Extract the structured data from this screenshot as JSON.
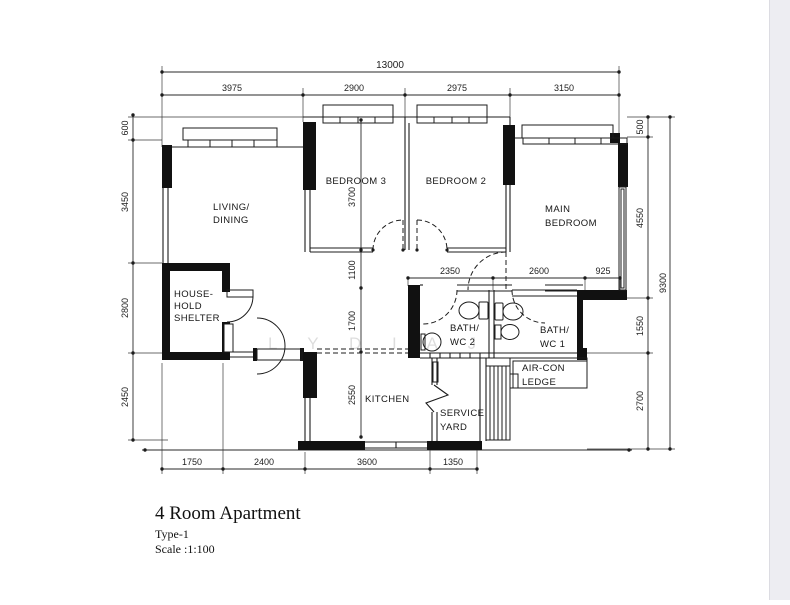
{
  "drawing": {
    "title": "4 Room Apartment",
    "type_label": "Type-1",
    "scale_label": "Scale :1:100",
    "watermark": "L Y D I A J"
  },
  "rooms": {
    "living_line1": "LIVING/",
    "living_line2": "DINING",
    "bedroom3": "BEDROOM 3",
    "bedroom2": "BEDROOM 2",
    "main_line1": "MAIN",
    "main_line2": "BEDROOM",
    "shelter_line1": "HOUSE-",
    "shelter_line2": "HOLD",
    "shelter_line3": "SHELTER",
    "bath2_line1": "BATH/",
    "bath2_line2": "WC 2",
    "bath1_line1": "BATH/",
    "bath1_line2": "WC 1",
    "kitchen": "KITCHEN",
    "service_line1": "SERVICE",
    "service_line2": "YARD",
    "aircon_line1": "AIR-CON",
    "aircon_line2": "LEDGE"
  },
  "dims": {
    "overall_width": "13000",
    "top": [
      "3975",
      "2900",
      "2975",
      "3150"
    ],
    "left": [
      "600",
      "3450",
      "2800",
      "2450"
    ],
    "right": [
      "500",
      "4550",
      "1550",
      "2700"
    ],
    "right_total": "9300",
    "bottom": [
      "1750",
      "2400",
      "3600",
      "1350"
    ],
    "inner_vertical": [
      "3700",
      "1100",
      "1700",
      "2550"
    ],
    "inner_horizontal": [
      "2350",
      "2600",
      "925"
    ]
  },
  "colors": {
    "ink": "#1c1c1c",
    "paper": "#ffffff",
    "edge": "#ededf2"
  }
}
